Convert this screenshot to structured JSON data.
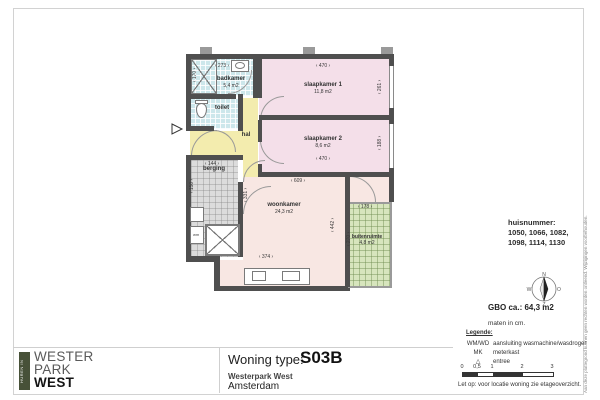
{
  "plan": {
    "rooms": {
      "badkamer": {
        "name": "badkamer",
        "area": "5,4 m2"
      },
      "toilet": {
        "name": "toilet"
      },
      "hal": {
        "name": "hal"
      },
      "berging": {
        "name": "berging"
      },
      "slaapkamer1": {
        "name": "slaapkamer 1",
        "area": "11,8 m2"
      },
      "slaapkamer2": {
        "name": "slaapkamer 2",
        "area": "8,6 m2"
      },
      "woonkamer": {
        "name": "woonkamer",
        "area": "24,3 m2"
      },
      "buitenruimte": {
        "name": "buitenruimte",
        "area": "4,8 m2"
      }
    },
    "dims": {
      "badkamer_w": "273",
      "shower_h": "170",
      "sk1_w": "470",
      "sk1_h": "261",
      "sk2_w": "470",
      "sk2_h": "188",
      "woonkamer_top_w": "609",
      "berging_w": "144",
      "berging_h": "150",
      "hal_wall_h": "331",
      "woonkamer_w": "374",
      "woonkamer_h": "442",
      "balkon_w": "178",
      "balkon_h": "270"
    },
    "fixtures": {
      "wm_label": "wm"
    }
  },
  "sidebar": {
    "huisnummer_label": "huisnummer:",
    "huisnummer_line1": "1050, 1066, 1082,",
    "huisnummer_line2": "1098, 1114, 1130",
    "compass": {
      "n": "N",
      "o": "O",
      "z": "Z",
      "w": "W"
    },
    "gbo": "GBO ca.:  64,3 m2",
    "units_note": "maten in cm.",
    "legend": {
      "title": "Legende:",
      "rows": [
        {
          "key": "WM/WD",
          "value": "aansluiting wasmachine/wasdroger"
        },
        {
          "key": "MK",
          "value": "meterkast"
        },
        {
          "key": "△",
          "value": "entree"
        }
      ]
    },
    "scale_ticks": [
      "0",
      "0,5",
      "1",
      "2",
      "3"
    ],
    "note": "Let op:  voor locatie woning zie etageoverzicht."
  },
  "titleblock": {
    "woning_type_label": "Woning type:",
    "woning_type_value": "S03B",
    "project": "Westerpark West",
    "city": "Amsterdam"
  },
  "logo": {
    "vertical": "HUREN IN",
    "line1": "WESTER",
    "line2": "PARK",
    "line3": "WEST"
  },
  "disclaimer": "Aan deze plattegrond kunnen geen rechten worden ontleend. Wijzigingen voorbehouden.",
  "colors": {
    "wall": "#4f4f4f",
    "bedroom": "#f4dfe9",
    "living": "#f8e7e3",
    "hall": "#f3ecae",
    "bath": "#cde7eb",
    "storage": "#dcdcdc",
    "balcony": "#d7e5bd",
    "logo_green": "#475138"
  }
}
